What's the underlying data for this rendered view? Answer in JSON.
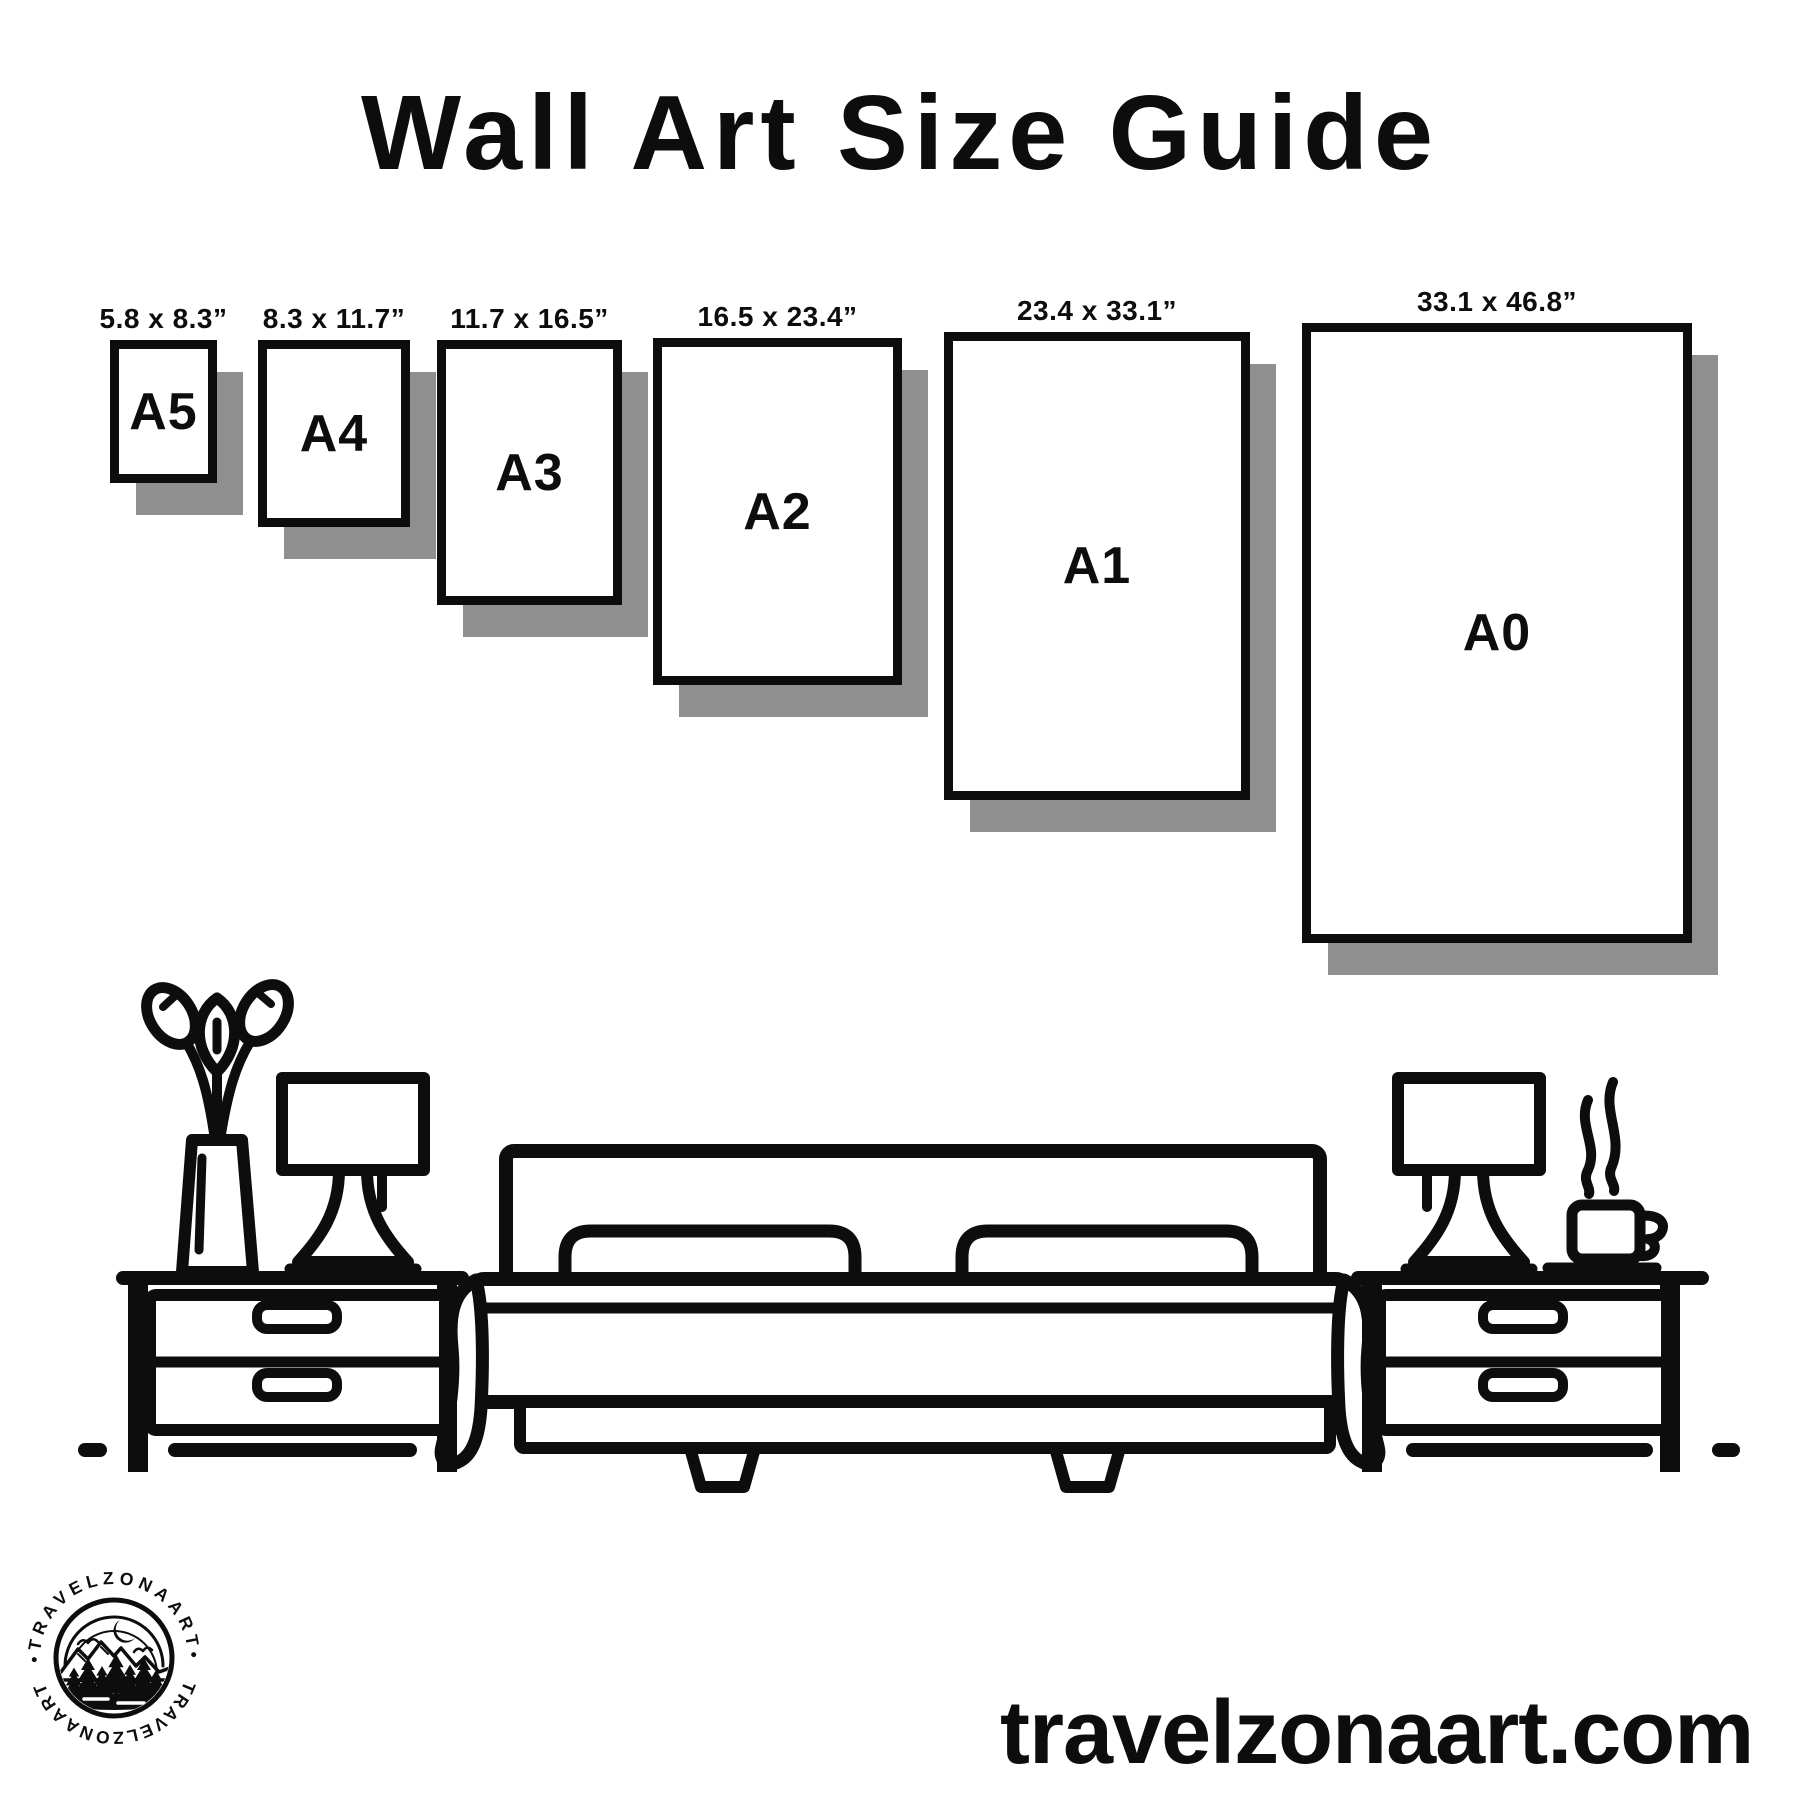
{
  "page": {
    "title": "Wall Art Size Guide"
  },
  "sizes": [
    {
      "code": "A5",
      "dimensions": "5.8 x 8.3”"
    },
    {
      "code": "A4",
      "dimensions": "8.3 x 11.7”"
    },
    {
      "code": "A3",
      "dimensions": "11.7 x 16.5”"
    },
    {
      "code": "A2",
      "dimensions": "16.5 x 23.4”"
    },
    {
      "code": "A1",
      "dimensions": "23.4 x 33.1”"
    },
    {
      "code": "A0",
      "dimensions": "33.1 x 46.8”"
    }
  ],
  "brand": {
    "website": "travelzonaart.com",
    "logo_ring_top": "•TRAVELZONAART•",
    "logo_ring_bottom": "TRAVELZONAART"
  },
  "colors": {
    "ink": "#0d0d0d",
    "shadow": "#8f8f8f",
    "background": "#ffffff"
  },
  "illustration": {
    "items": [
      "vase-plant",
      "table-lamp",
      "nightstand",
      "bed-with-pillows-and-blanket",
      "nightstand",
      "table-lamp",
      "steaming-coffee-cup"
    ]
  }
}
